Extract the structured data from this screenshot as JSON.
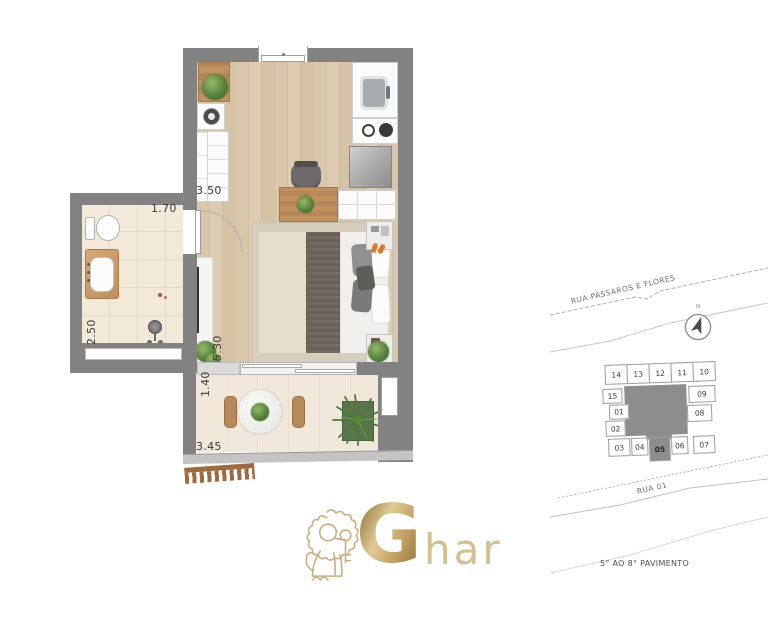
{
  "brand": {
    "logo_initial": "G",
    "logo_rest": "har",
    "gold": "#c2a571"
  },
  "floor_plan": {
    "dimensions": {
      "kitchen_width": "3.50",
      "bathroom_width": "1.70",
      "bathroom_depth": "2.50",
      "living_length": "5.30",
      "balcony_depth": "1.40",
      "balcony_width": "3.45"
    },
    "colors": {
      "wall": "#828282",
      "wood_floor": "#d8c5a8",
      "bathroom_floor": "#f2e7d6",
      "balcony_floor": "#f0e7da"
    }
  },
  "site_map": {
    "street_top": "RUA PÁSSAROS E FLORES",
    "street_bottom": "RUA 01",
    "caption": "5° AO 8° PAVIMENTO",
    "north_label": "N",
    "key_plan": {
      "highlighted_unit": "05",
      "units_top": [
        "14",
        "13",
        "12",
        "11",
        "10"
      ],
      "units_left": [
        "15",
        "01",
        "02"
      ],
      "units_right": [
        "09",
        "08"
      ],
      "units_bottom": [
        "03",
        "04",
        "05",
        "06",
        "07"
      ]
    }
  }
}
